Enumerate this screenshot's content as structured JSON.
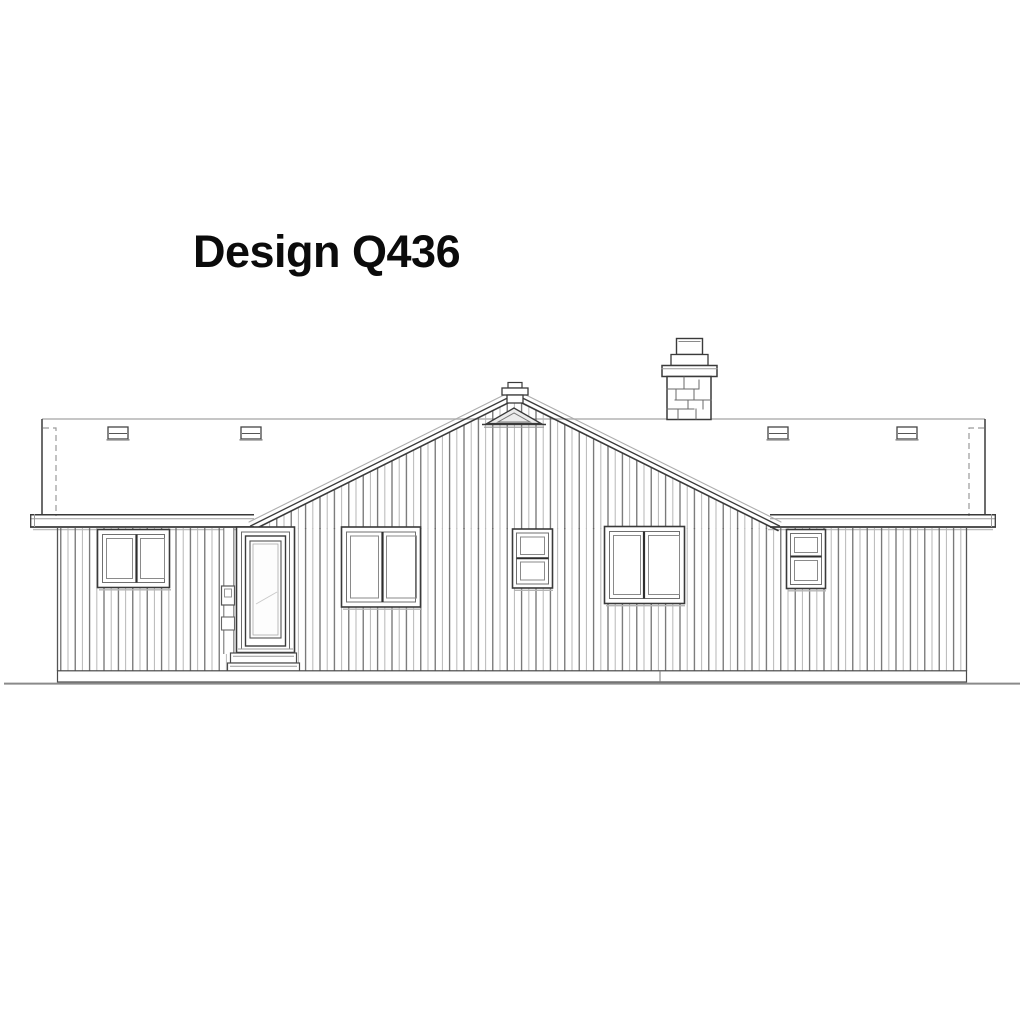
{
  "title": "Design Q436",
  "drawing": {
    "subject": "house-rear-elevation",
    "ink_color": "#3a3a3a",
    "mid_ink_color": "#6a6a6a",
    "light_ink_color": "#b3b3b3",
    "paper_color": "#ffffff"
  }
}
